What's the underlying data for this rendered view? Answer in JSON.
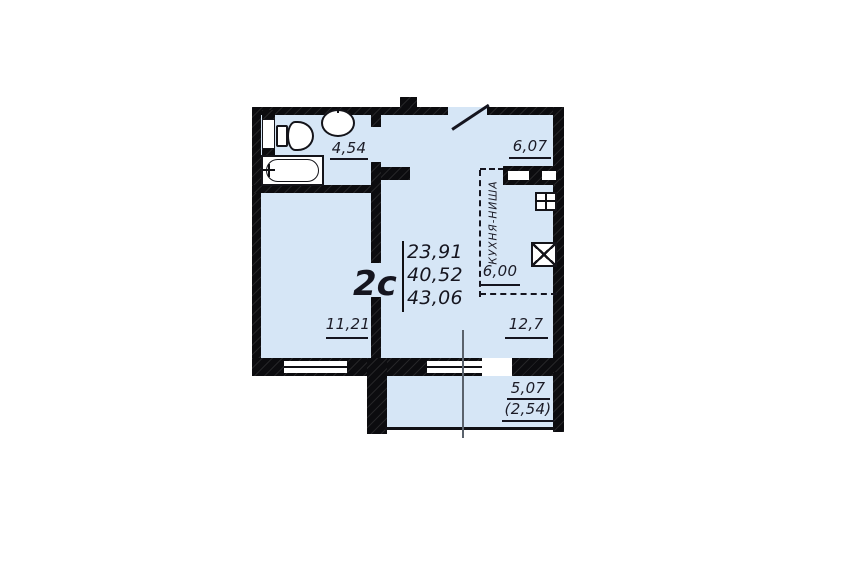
{
  "plan": {
    "title": "2с",
    "area_summary": [
      "23,91",
      "40,52",
      "43,06"
    ],
    "rooms": {
      "bathroom": {
        "area": "4,54"
      },
      "hallway": {
        "area": "6,07"
      },
      "kitchen_niche": {
        "label": "КУХНЯ-НИША",
        "area": "6,00"
      },
      "living_room": {
        "area": "11,21"
      },
      "room": {
        "area": "12,7"
      },
      "balcony": {
        "area": "5,07",
        "area_coefficient": "(2,54)"
      }
    }
  },
  "colors": {
    "interior": "#d6e6f6",
    "wall": "#0c0c0f",
    "text": "#1b1b26",
    "section_line": "#5a626c"
  }
}
